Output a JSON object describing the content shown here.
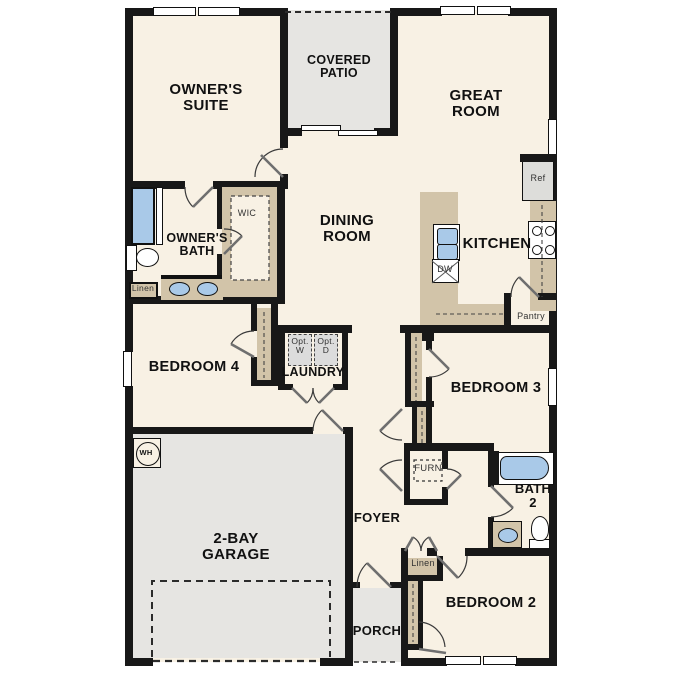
{
  "title": "Single-story floor plan",
  "colors": {
    "room_fill": "#f8f1e4",
    "outdoor_fill": "#e6e5e2",
    "wall": "#181818",
    "casework": "#d2c4a9",
    "fixture_blue": "#a9c9e8",
    "appliance_gray": "#dcdcdc"
  },
  "labels": [
    {
      "id": "owners-suite",
      "text": "OWNER'S\nSUITE",
      "x": 206,
      "y": 82,
      "fs": 15,
      "b": 1
    },
    {
      "id": "covered-patio",
      "text": "COVERED\nPATIO",
      "x": 339,
      "y": 54,
      "fs": 12.5,
      "b": 1
    },
    {
      "id": "great-room",
      "text": "GREAT\nROOM",
      "x": 476,
      "y": 88,
      "fs": 15,
      "b": 1
    },
    {
      "id": "dining-room",
      "text": "DINING\nROOM",
      "x": 347,
      "y": 213,
      "fs": 15,
      "b": 1
    },
    {
      "id": "kitchen",
      "text": "KITCHEN",
      "x": 497,
      "y": 236,
      "fs": 15,
      "b": 1
    },
    {
      "id": "owners-bath",
      "text": "OWNER'S\nBATH",
      "x": 197,
      "y": 232,
      "fs": 12.5,
      "b": 1
    },
    {
      "id": "wic",
      "text": "WIC",
      "x": 247,
      "y": 209,
      "fs": 9,
      "b": 0
    },
    {
      "id": "linen-bath",
      "text": "Linen",
      "x": 143,
      "y": 284,
      "fs": 8.5,
      "b": 0
    },
    {
      "id": "bedroom4",
      "text": "BEDROOM 4",
      "x": 194,
      "y": 360,
      "fs": 14.5,
      "b": 1
    },
    {
      "id": "laundry",
      "text": "LAUNDRY",
      "x": 313,
      "y": 366,
      "fs": 12.5,
      "b": 1
    },
    {
      "id": "opt-w",
      "text": "Opt.\nW",
      "x": 300,
      "y": 337,
      "fs": 8.5,
      "b": 0
    },
    {
      "id": "opt-d",
      "text": "Opt.\nD",
      "x": 326,
      "y": 337,
      "fs": 8.5,
      "b": 0
    },
    {
      "id": "bedroom3",
      "text": "BEDROOM 3",
      "x": 496,
      "y": 381,
      "fs": 14.5,
      "b": 1
    },
    {
      "id": "pantry",
      "text": "Pantry",
      "x": 531,
      "y": 312,
      "fs": 9,
      "b": 0
    },
    {
      "id": "ref",
      "text": "Ref",
      "x": 538,
      "y": 174,
      "fs": 9,
      "b": 0
    },
    {
      "id": "dw",
      "text": "DW",
      "x": 445,
      "y": 265,
      "fs": 9,
      "b": 0
    },
    {
      "id": "furn",
      "text": "FURN",
      "x": 428,
      "y": 464,
      "fs": 9.5,
      "b": 0
    },
    {
      "id": "foyer",
      "text": "FOYER",
      "x": 377,
      "y": 511,
      "fs": 13,
      "b": 1
    },
    {
      "id": "garage",
      "text": "2-BAY\nGARAGE",
      "x": 236,
      "y": 531,
      "fs": 15,
      "b": 1
    },
    {
      "id": "bath2",
      "text": "BATH\n2",
      "x": 533,
      "y": 482,
      "fs": 13,
      "b": 1
    },
    {
      "id": "linen-hall",
      "text": "Linen",
      "x": 423,
      "y": 559,
      "fs": 9,
      "b": 0
    },
    {
      "id": "bedroom2",
      "text": "BEDROOM 2",
      "x": 491,
      "y": 596,
      "fs": 14.5,
      "b": 1
    },
    {
      "id": "porch",
      "text": "PORCH",
      "x": 377,
      "y": 624,
      "fs": 13,
      "b": 1
    },
    {
      "id": "wh",
      "text": "WH",
      "x": 146,
      "y": 449,
      "fs": 7.5,
      "b": 1
    }
  ]
}
